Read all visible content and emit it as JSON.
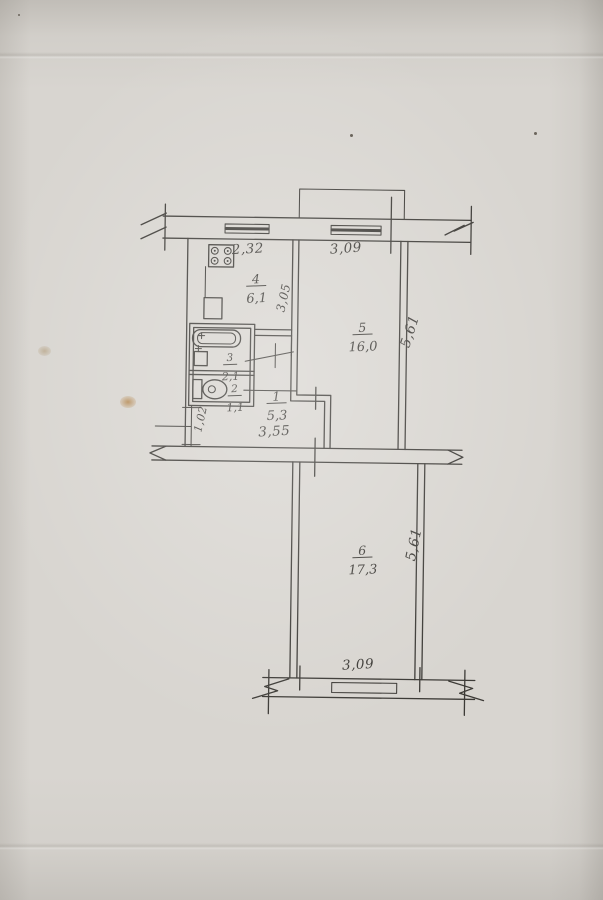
{
  "colors": {
    "paper": "#d8d5d0",
    "ink": "#3c3a36",
    "stain": "#b5854a"
  },
  "rooms": {
    "kitchen": {
      "number": "4",
      "area": "6,1"
    },
    "living": {
      "number": "5",
      "area": "16,0"
    },
    "bathroom": {
      "number": "3",
      "area": "2,1"
    },
    "wc": {
      "number": "2",
      "area": "1,1"
    },
    "hall": {
      "number": "1",
      "area": "5,3"
    },
    "room6": {
      "number": "6",
      "area": "17,3"
    }
  },
  "dimensions": {
    "top_left_width": "2,32",
    "top_right_width": "3,09",
    "kitchen_depth": "3,05",
    "upper_right_height": "5,61",
    "hall_width": "3,55",
    "entry_height": "1,02",
    "lower_right_height": "5,61",
    "bottom_width": "3,09"
  }
}
